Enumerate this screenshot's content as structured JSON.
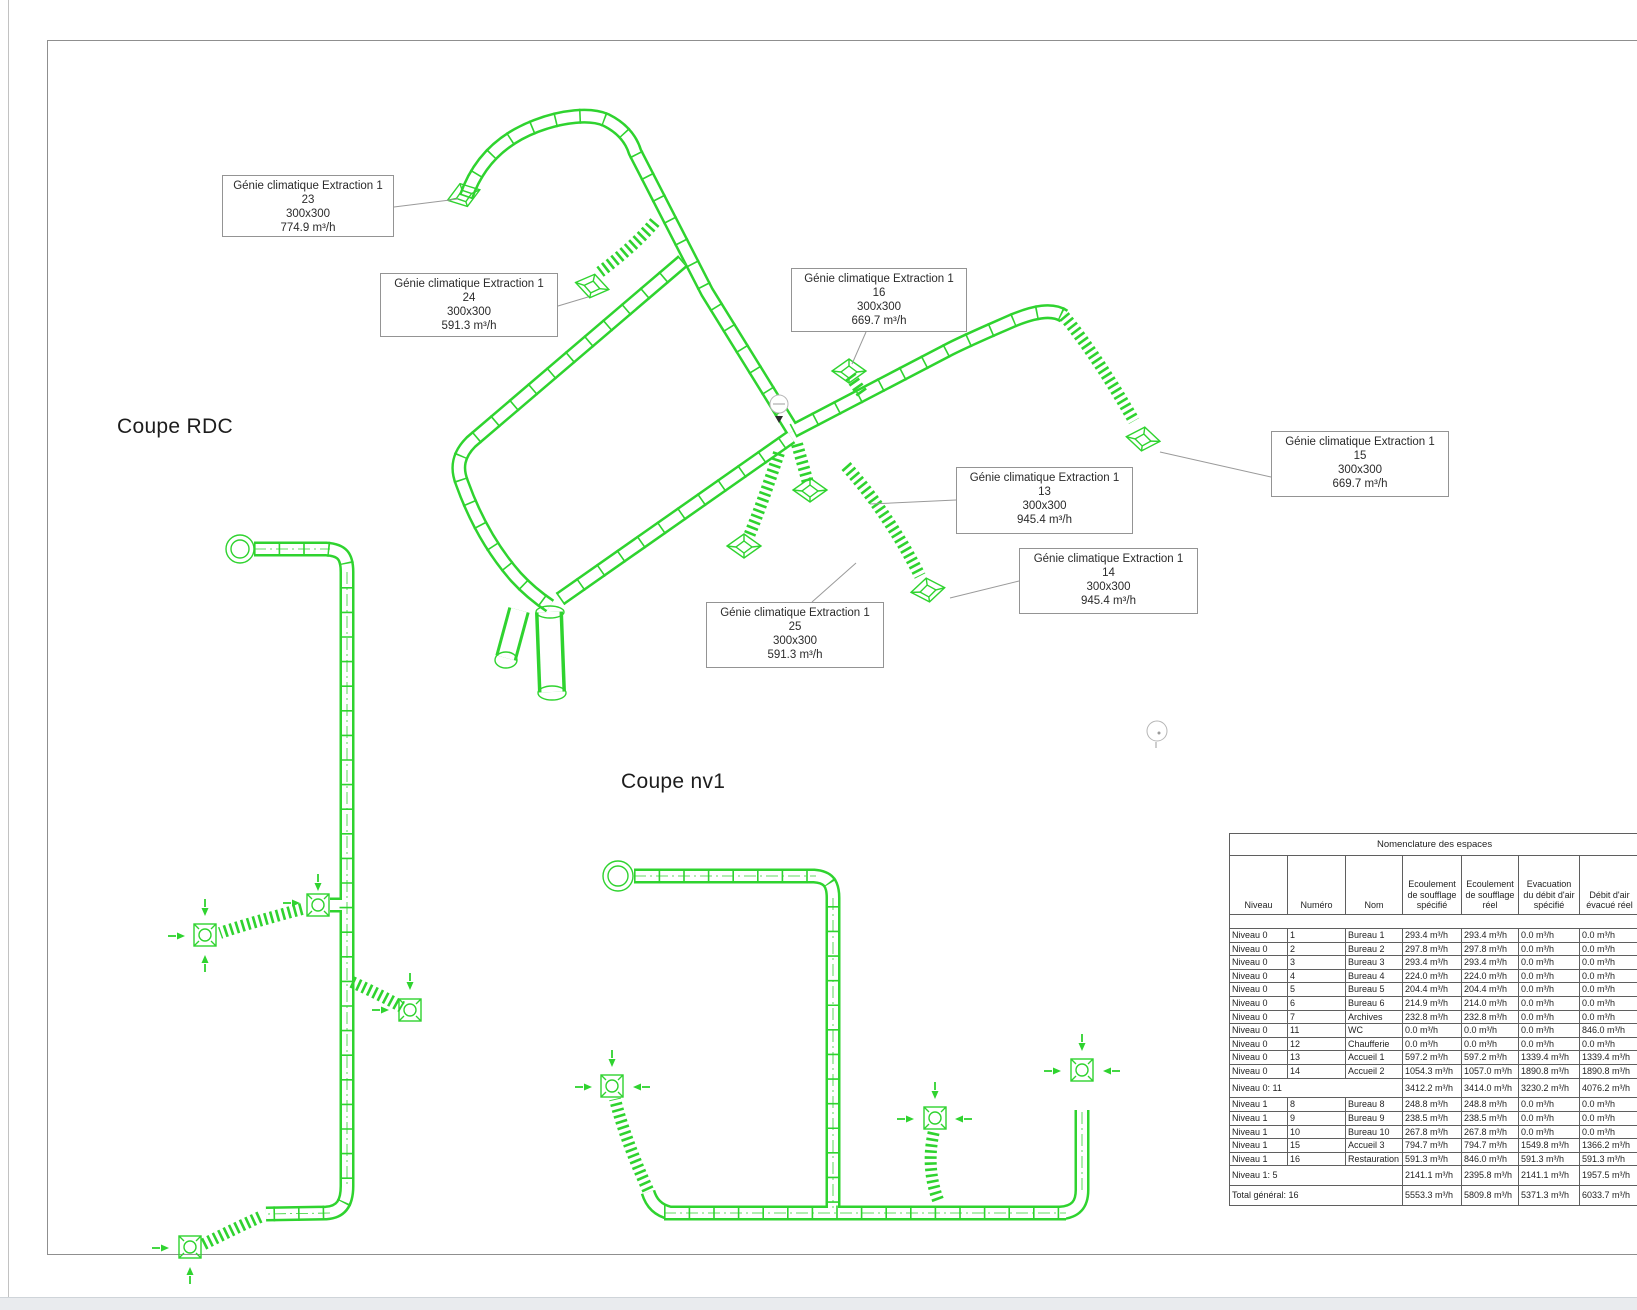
{
  "colors": {
    "duct_green": "#2fd32f"
  },
  "views": {
    "rdc_title": "Coupe RDC",
    "nv1_title": "Coupe nv1"
  },
  "annotations": [
    {
      "title": "Génie climatique Extraction 1",
      "number": "23",
      "size": "300x300",
      "flow": "774.9 m³/h"
    },
    {
      "title": "Génie climatique Extraction 1",
      "number": "24",
      "size": "300x300",
      "flow": "591.3 m³/h"
    },
    {
      "title": "Génie climatique Extraction 1",
      "number": "16",
      "size": "300x300",
      "flow": "669.7 m³/h"
    },
    {
      "title": "Génie climatique Extraction 1",
      "number": "15",
      "size": "300x300",
      "flow": "669.7 m³/h"
    },
    {
      "title": "Génie climatique Extraction 1",
      "number": "13",
      "size": "300x300",
      "flow": "945.4 m³/h"
    },
    {
      "title": "Génie climatique Extraction 1",
      "number": "14",
      "size": "300x300",
      "flow": "945.4 m³/h"
    },
    {
      "title": "Génie climatique Extraction 1",
      "number": "25",
      "size": "300x300",
      "flow": "591.3 m³/h"
    }
  ],
  "table": {
    "title": "Nomenclature des espaces",
    "columns": [
      "Niveau",
      "Numéro",
      "Nom",
      "Ecoulement de soufflage spécifié",
      "Ecoulement de soufflage réel",
      "Evacuation du débit d'air spécifié",
      "Débit d'air évacué réel"
    ],
    "rows": [
      {
        "spacer": true
      },
      {
        "niveau": "Niveau 0",
        "numero": "1",
        "nom": "Bureau 1",
        "values": [
          "293.4 m³/h",
          "293.4 m³/h",
          "0.0 m³/h",
          "0.0 m³/h"
        ]
      },
      {
        "niveau": "Niveau 0",
        "numero": "2",
        "nom": "Bureau 2",
        "values": [
          "297.8 m³/h",
          "297.8 m³/h",
          "0.0 m³/h",
          "0.0 m³/h"
        ]
      },
      {
        "niveau": "Niveau 0",
        "numero": "3",
        "nom": "Bureau 3",
        "values": [
          "293.4 m³/h",
          "293.4 m³/h",
          "0.0 m³/h",
          "0.0 m³/h"
        ]
      },
      {
        "niveau": "Niveau 0",
        "numero": "4",
        "nom": "Bureau 4",
        "values": [
          "224.0 m³/h",
          "224.0 m³/h",
          "0.0 m³/h",
          "0.0 m³/h"
        ]
      },
      {
        "niveau": "Niveau 0",
        "numero": "5",
        "nom": "Bureau 5",
        "values": [
          "204.4 m³/h",
          "204.4 m³/h",
          "0.0 m³/h",
          "0.0 m³/h"
        ]
      },
      {
        "niveau": "Niveau 0",
        "numero": "6",
        "nom": "Bureau 6",
        "values": [
          "214.9 m³/h",
          "214.0 m³/h",
          "0.0 m³/h",
          "0.0 m³/h"
        ]
      },
      {
        "niveau": "Niveau 0",
        "numero": "7",
        "nom": "Archives",
        "values": [
          "232.8 m³/h",
          "232.8 m³/h",
          "0.0 m³/h",
          "0.0 m³/h"
        ]
      },
      {
        "niveau": "Niveau 0",
        "numero": "11",
        "nom": "WC",
        "values": [
          "0.0 m³/h",
          "0.0 m³/h",
          "0.0 m³/h",
          "846.0 m³/h"
        ]
      },
      {
        "niveau": "Niveau 0",
        "numero": "12",
        "nom": "Chaufferie",
        "values": [
          "0.0 m³/h",
          "0.0 m³/h",
          "0.0 m³/h",
          "0.0 m³/h"
        ]
      },
      {
        "niveau": "Niveau 0",
        "numero": "13",
        "nom": "Accueil 1",
        "values": [
          "597.2 m³/h",
          "597.2 m³/h",
          "1339.4 m³/h",
          "1339.4 m³/h"
        ]
      },
      {
        "niveau": "Niveau 0",
        "numero": "14",
        "nom": "Accueil 2",
        "values": [
          "1054.3 m³/h",
          "1057.0 m³/h",
          "1890.8 m³/h",
          "1890.8 m³/h"
        ]
      },
      {
        "label": "Niveau 0: 11",
        "values": [
          "3412.2 m³/h",
          "3414.0 m³/h",
          "3230.2 m³/h",
          "4076.2 m³/h"
        ]
      },
      {
        "niveau": "Niveau 1",
        "numero": "8",
        "nom": "Bureau 8",
        "values": [
          "248.8 m³/h",
          "248.8 m³/h",
          "0.0 m³/h",
          "0.0 m³/h"
        ]
      },
      {
        "niveau": "Niveau 1",
        "numero": "9",
        "nom": "Bureau 9",
        "values": [
          "238.5 m³/h",
          "238.5 m³/h",
          "0.0 m³/h",
          "0.0 m³/h"
        ]
      },
      {
        "niveau": "Niveau 1",
        "numero": "10",
        "nom": "Bureau 10",
        "values": [
          "267.8 m³/h",
          "267.8 m³/h",
          "0.0 m³/h",
          "0.0 m³/h"
        ]
      },
      {
        "niveau": "Niveau 1",
        "numero": "15",
        "nom": "Accueil 3",
        "values": [
          "794.7 m³/h",
          "794.7 m³/h",
          "1549.8 m³/h",
          "1366.2 m³/h"
        ]
      },
      {
        "niveau": "Niveau 1",
        "numero": "16",
        "nom": "Restauration",
        "values": [
          "591.3 m³/h",
          "846.0 m³/h",
          "591.3 m³/h",
          "591.3 m³/h"
        ]
      },
      {
        "label": "Niveau 1: 5",
        "values": [
          "2141.1 m³/h",
          "2395.8 m³/h",
          "2141.1 m³/h",
          "1957.5 m³/h"
        ]
      },
      {
        "label": "Total général: 16",
        "values": [
          "5553.3 m³/h",
          "5809.8 m³/h",
          "5371.3 m³/h",
          "6033.7 m³/h"
        ]
      }
    ]
  }
}
